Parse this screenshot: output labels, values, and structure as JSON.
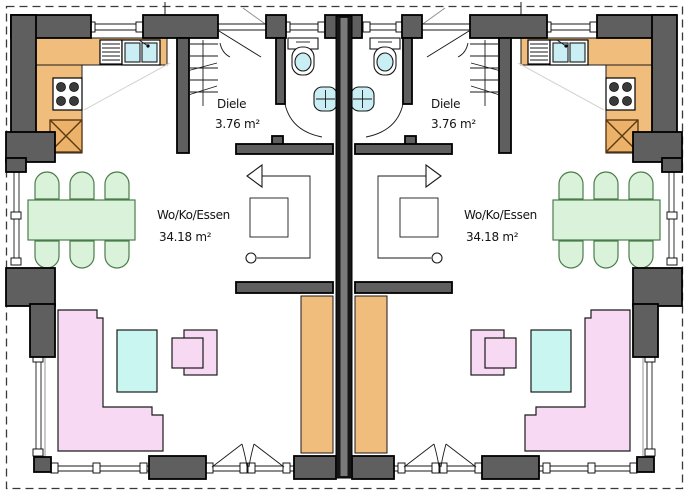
{
  "document": {
    "type": "floor-plan",
    "description": "ground floor plan of a semi-detached house, two mirrored units"
  },
  "units": [
    {
      "side": "left",
      "rooms": [
        {
          "name": "Diele",
          "area": "3.76 m²"
        },
        {
          "name": "Wo/Ko/Essen",
          "area": "34.18 m²"
        }
      ]
    },
    {
      "side": "right",
      "rooms": [
        {
          "name": "Diele",
          "area": "3.76 m²"
        },
        {
          "name": "Wo/Ko/Essen",
          "area": "34.18 m²"
        }
      ]
    }
  ],
  "fixtures": [
    "kitchen-counter",
    "sink",
    "dishwasher",
    "stove",
    "fridge-block",
    "stairs",
    "toilet",
    "washbasin",
    "dining-table",
    "chair",
    "sofa",
    "coffee-table",
    "armchair",
    "entrance-door",
    "terrace-door",
    "window"
  ],
  "colors": {
    "wall": "#5f5f5f",
    "party_wall": "#161616",
    "kitchen_counter": "#f1bd7d",
    "water_fixture": "#c9eef4",
    "coffee_table": "#c9f6f0",
    "dining_furniture": "#daf2da",
    "upholstery": "#f8d9f4"
  }
}
